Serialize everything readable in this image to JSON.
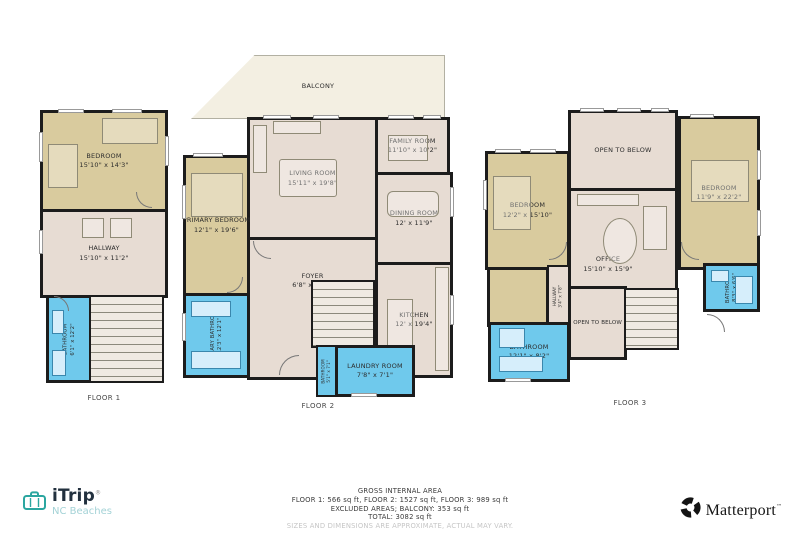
{
  "colors": {
    "wall": "#1c1c1c",
    "bedroom_fill": "#d9cb9e",
    "common_fill": "#e7dcd3",
    "bathroom_fill": "#6fc9ec",
    "balcony_fill": "#f3efe2",
    "itrip_teal": "#2ba6a0",
    "itrip_sub_teal": "#a3d2d6",
    "matterport_black": "#141414",
    "disclaimer_gray": "#c6c6c6"
  },
  "floor1": {
    "label": "FLOOR 1",
    "bedroom": {
      "name": "BEDROOM",
      "dims": "15'10\" x 14'3\""
    },
    "hallway": {
      "name": "HALLWAY",
      "dims": "15'10\" x 11'2\""
    },
    "bathroom": {
      "name": "BATHROOM",
      "dims": "6'1\" x 12'2\""
    }
  },
  "floor2": {
    "label": "FLOOR 2",
    "balcony": {
      "name": "BALCONY"
    },
    "living": {
      "name": "LIVING ROOM",
      "dims": "15'11\" x 19'8\""
    },
    "family": {
      "name": "FAMILY ROOM",
      "dims": "11'10\" x 10'2\""
    },
    "primary_bedroom": {
      "name": "PRIMARY BEDROOM",
      "dims": "12'1\" x 19'6\""
    },
    "primary_bathroom": {
      "name": "PRIMARY BATHROOM",
      "dims": "12'3\" x 12'1\""
    },
    "foyer": {
      "name": "FOYER",
      "dims": "6'8\" x 18'6\""
    },
    "dining": {
      "name": "DINING ROOM",
      "dims": "12' x 11'9\""
    },
    "kitchen": {
      "name": "KITCHEN",
      "dims": "12' x 19'4\""
    },
    "laundry": {
      "name": "LAUNDRY ROOM",
      "dims": "7'8\" x 7'1\""
    },
    "bathroom": {
      "name": "BATHROOM",
      "dims": "5'1\" x 7'1\""
    }
  },
  "floor3": {
    "label": "FLOOR 3",
    "open_top": {
      "name": "OPEN TO BELOW"
    },
    "open_bottom": {
      "name": "OPEN TO BELOW"
    },
    "bedroom_left": {
      "name": "BEDROOM",
      "dims": "12'2\" x 15'10\""
    },
    "bedroom_right": {
      "name": "BEDROOM",
      "dims": "11'9\" x 22'2\""
    },
    "office": {
      "name": "OFFICE",
      "dims": "15'10\" x 15'9\""
    },
    "hallway": {
      "name": "HALLWAY",
      "dims": "3'4\" x 7'8\""
    },
    "bathroom_left": {
      "name": "BATHROOM",
      "dims": "12'1\" x 8'2\""
    },
    "bathroom_right": {
      "name": "BATHROOM",
      "dims": "8'3\" x 6'6\""
    }
  },
  "footer": {
    "title": "GROSS INTERNAL AREA",
    "areas": "FLOOR 1: 566 sq ft, FLOOR 2: 1527 sq ft, FLOOR 3: 989 sq ft",
    "excluded": "EXCLUDED AREAS; BALCONY: 353 sq ft",
    "total": "TOTAL: 3082 sq ft",
    "disclaimer": "SIZES AND DIMENSIONS ARE APPROXIMATE, ACTUAL MAY VARY."
  },
  "branding": {
    "itrip_name": "iTrip",
    "itrip_reg": "®",
    "itrip_sub": "NC Beaches",
    "matterport_name": "Matterport",
    "matterport_reg": "™"
  }
}
